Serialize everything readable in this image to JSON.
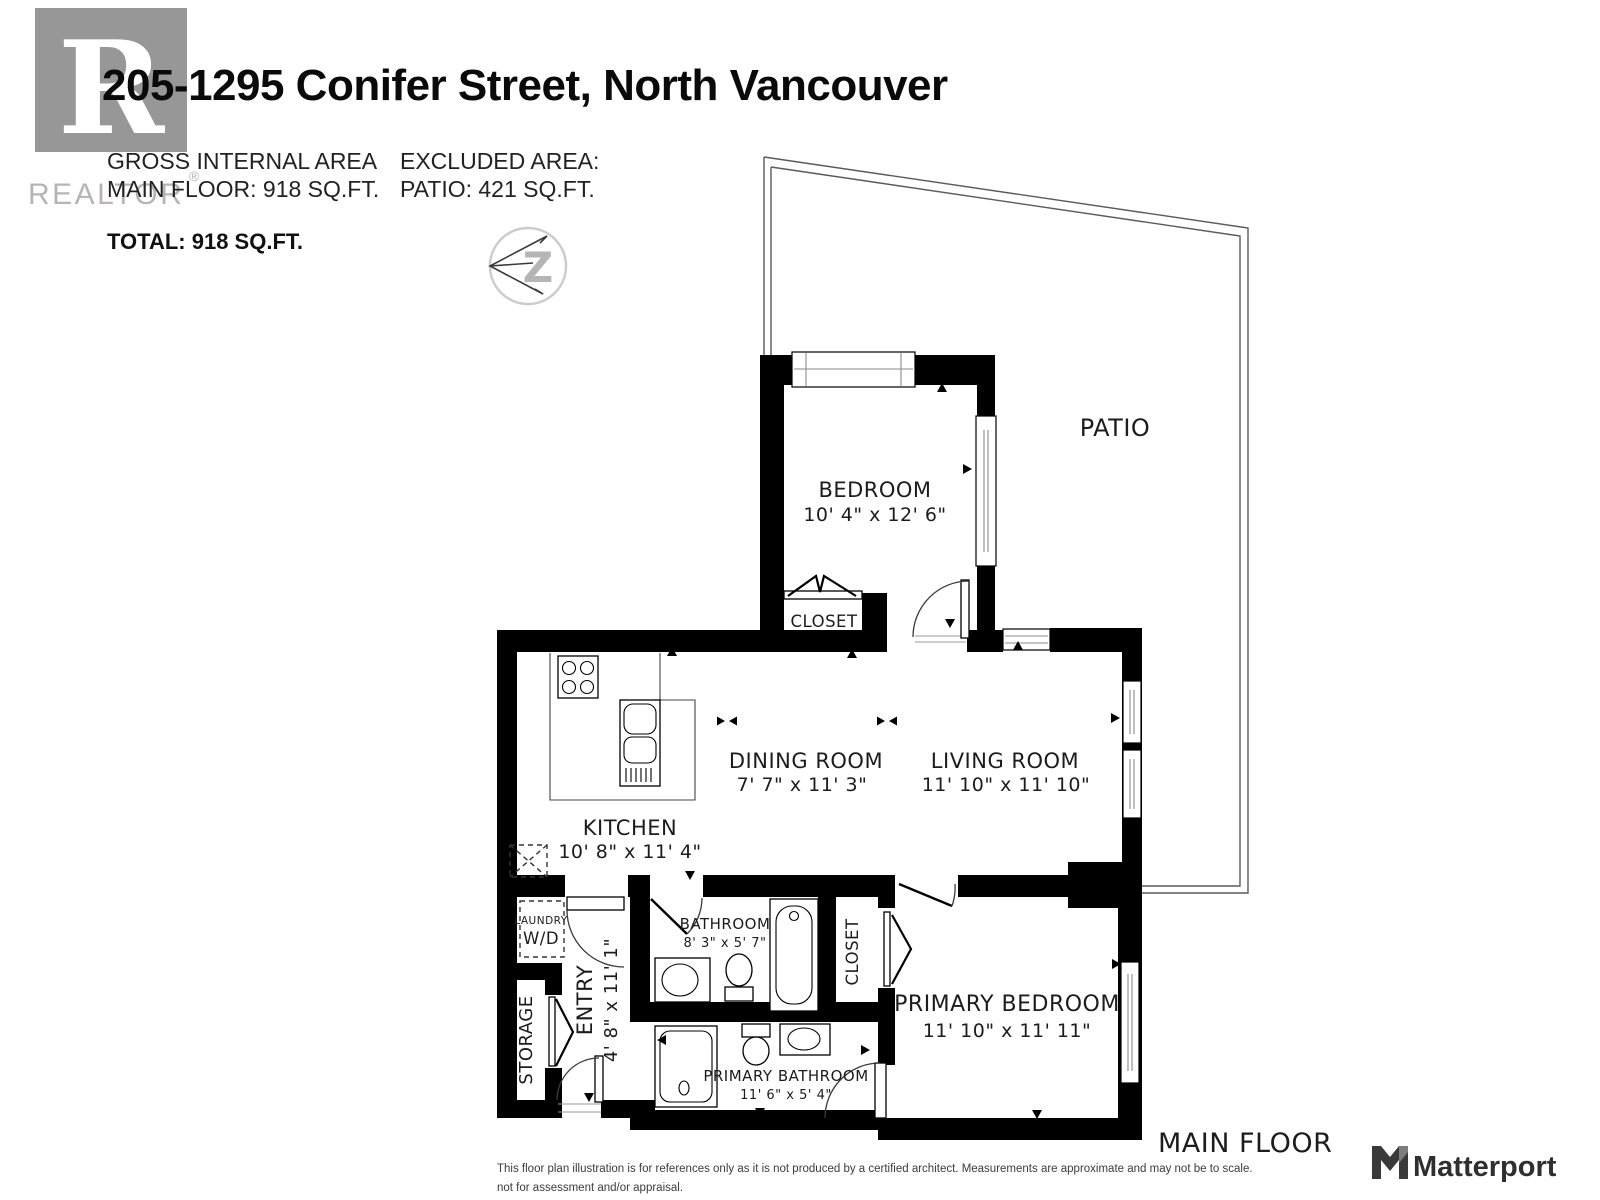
{
  "header": {
    "logo": {
      "letter": "R",
      "wordmark": "REALTOR",
      "registered": "®"
    },
    "title": "205-1295 Conifer Street, North Vancouver",
    "area_summary": {
      "gross_label": "GROSS INTERNAL AREA",
      "gross_value": "MAIN FLOOR: 918 SQ.FT.",
      "excluded_label": "EXCLUDED AREA:",
      "excluded_value": "PATIO: 421 SQ.FT.",
      "total": "TOTAL: 918 SQ.FT."
    },
    "compass_letter": "Z"
  },
  "plan": {
    "rooms": {
      "patio": {
        "name": "PATIO"
      },
      "bedroom": {
        "name": "BEDROOM",
        "dims": "10' 4\" x 12' 6\""
      },
      "bedroom_closet": {
        "name": "CLOSET"
      },
      "dining_room": {
        "name": "DINING ROOM",
        "dims": "7' 7\" x 11' 3\""
      },
      "living_room": {
        "name": "LIVING ROOM",
        "dims": "11' 10\" x 11' 10\""
      },
      "kitchen": {
        "name": "KITCHEN",
        "dims": "10' 8\" x 11' 4\""
      },
      "laundry": {
        "name": "LAUNDRY",
        "appliance": "W/D"
      },
      "storage": {
        "name": "STORAGE"
      },
      "entry": {
        "name": "ENTRY",
        "dims": "4' 8\" x 11' 1\""
      },
      "bathroom": {
        "name": "BATHROOM",
        "dims": "8' 3\" x 5' 7\""
      },
      "hall_closet": {
        "name": "CLOSET"
      },
      "primary_bedroom": {
        "name": "PRIMARY BEDROOM",
        "dims": "11' 10\" x 11' 11\""
      },
      "primary_bathroom": {
        "name": "PRIMARY BATHROOM",
        "dims": "11' 6\" x 5' 4\""
      }
    },
    "floor_label": "MAIN FLOOR"
  },
  "footer": {
    "disclaimer_line1": "This floor plan illustration is for references only as it is not produced by a certified architect. Measurements are approximate and may not be to scale.",
    "disclaimer_line2": "not for assessment and/or appraisal.",
    "brand": "Matterport"
  },
  "colors": {
    "wall": "#000000",
    "logo_gray": "#979797",
    "logo_text_gray": "#b8b4b4",
    "accent_text": "#1c1c1c"
  }
}
